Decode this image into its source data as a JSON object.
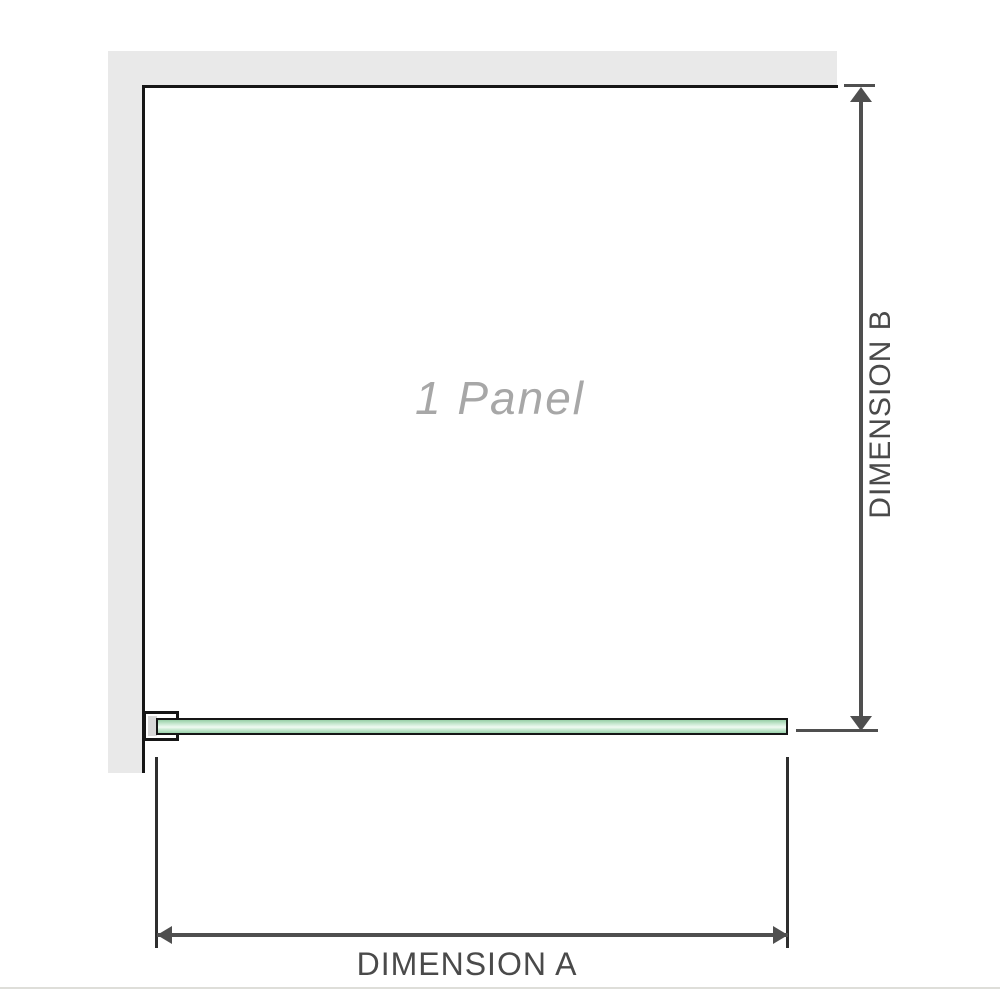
{
  "diagram": {
    "panel_label": "1 Panel",
    "dimension_a": {
      "label": "DIMENSION A"
    },
    "dimension_b": {
      "label": "DIMENSION B"
    },
    "colors": {
      "wall_fill": "#e9e9e9",
      "outline": "#161616",
      "dimension_line": "#4f4f4f",
      "dimension_text": "#4a4a4a",
      "panel_label_text": "#a7a7a7",
      "glass_green": "#9bd2ab",
      "glass_green_highlight": "#f0faf2",
      "bracket_gasket": "#d8d8d8",
      "baseline": "#deded9"
    }
  }
}
